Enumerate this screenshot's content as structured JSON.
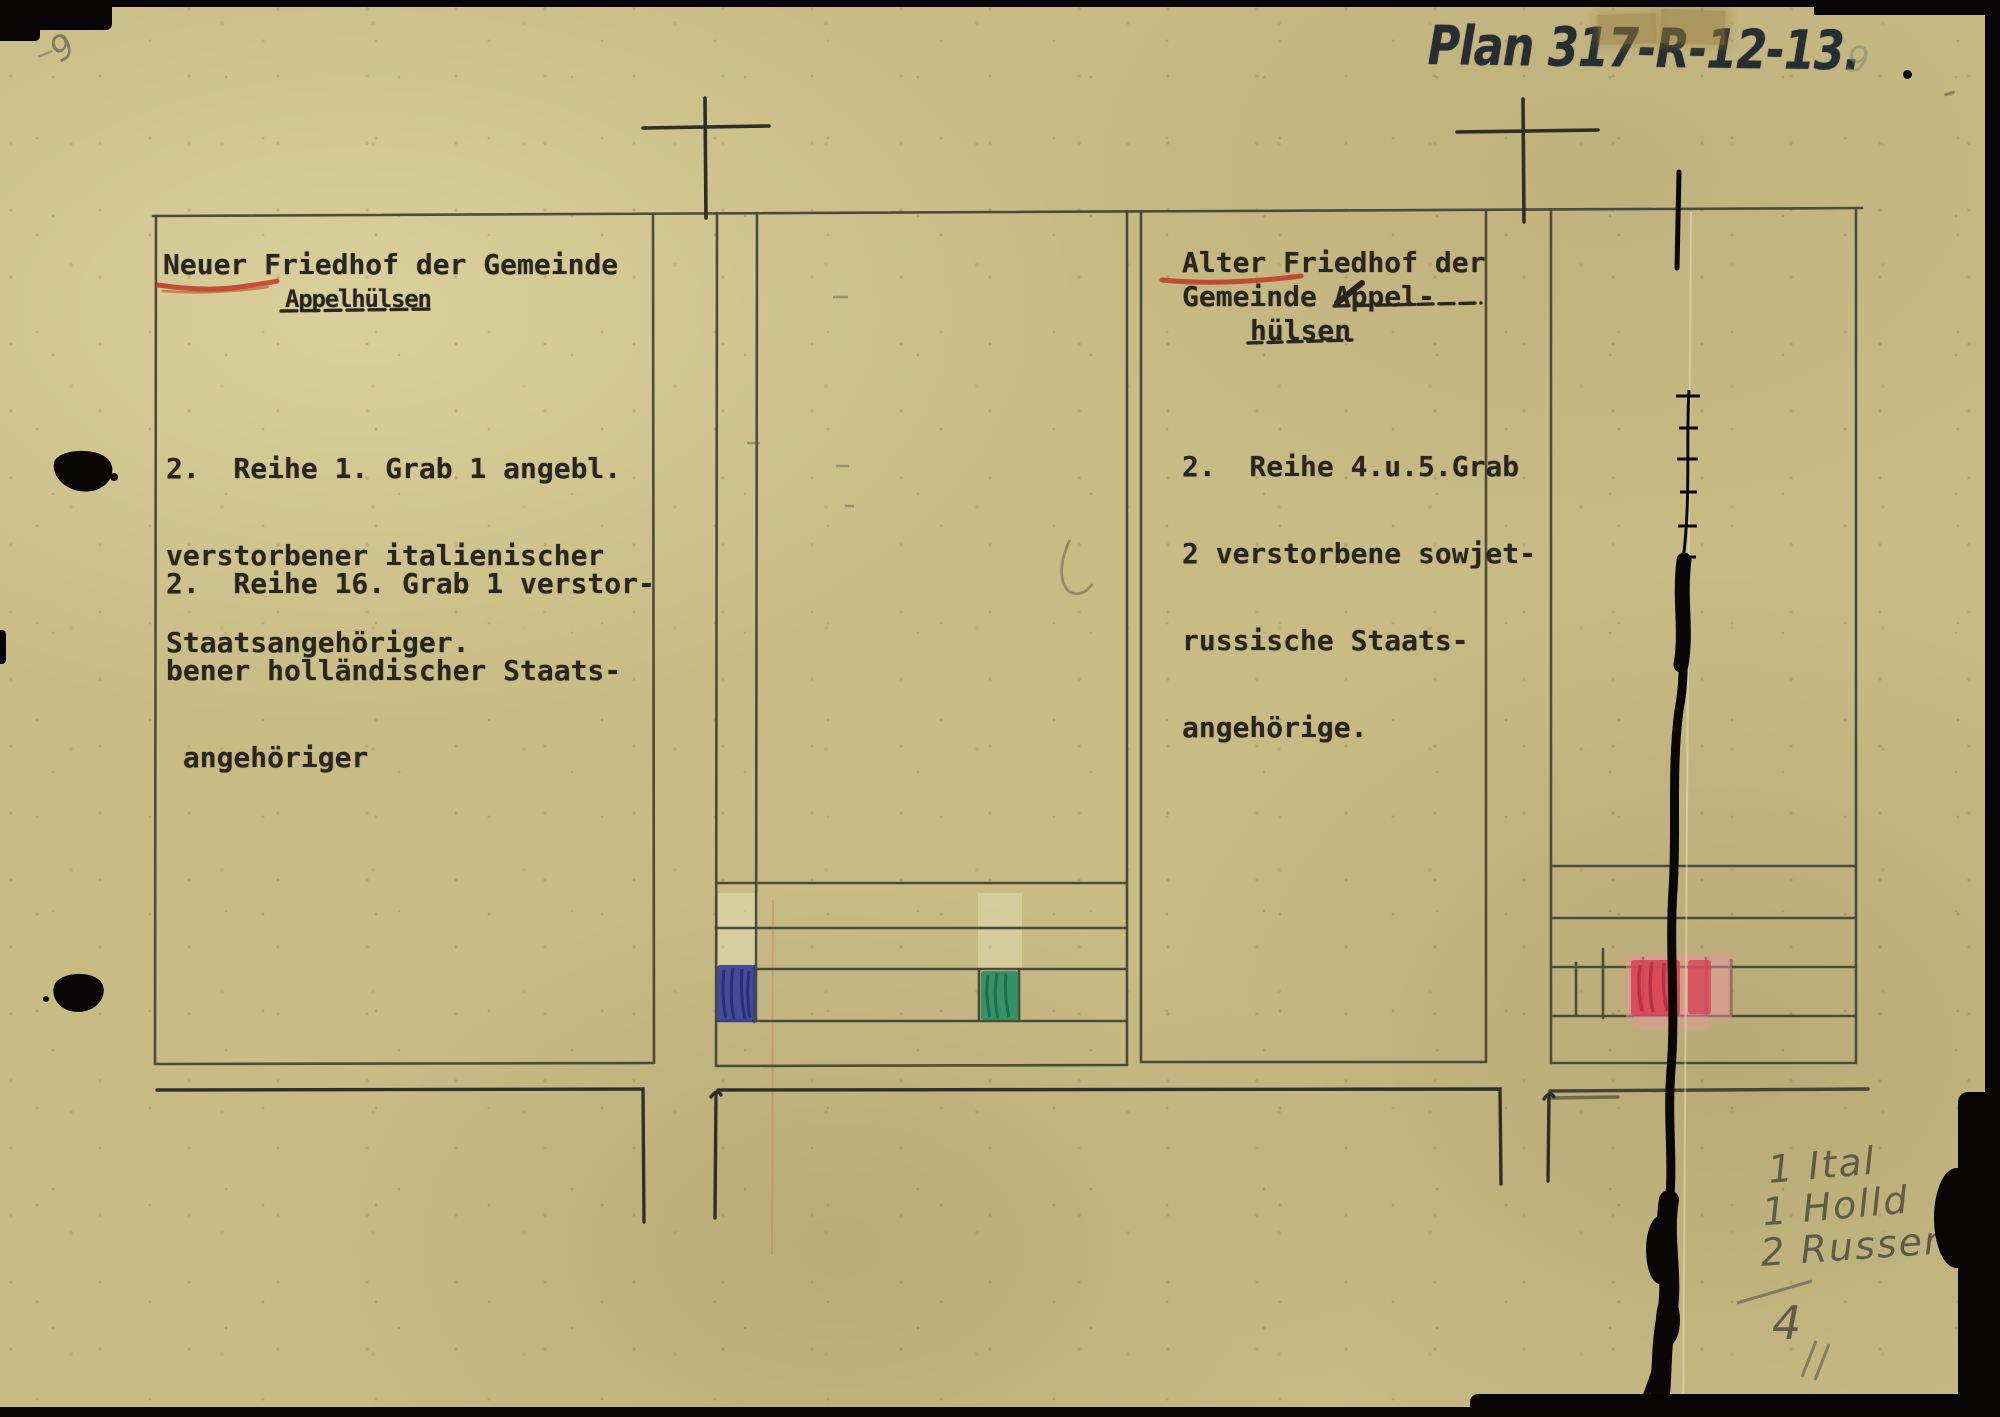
{
  "page": {
    "plan_label": "Plan 317-R-12-13.",
    "pencil_mark_top_left": "9",
    "pencil_mark_top_right": "9"
  },
  "new_cemetery": {
    "title_word_underlined": "Neuer",
    "title_rest": " Friedhof der Gemeinde",
    "title_line2": "Appelhülsen",
    "para1": [
      "2.  Reihe 1. Grab 1 angebl.",
      "verstorbener italienischer",
      "Staatsangehöriger."
    ],
    "para2": [
      "2.  Reihe 16. Grab 1 verstor-",
      "bener holländischer Staats-",
      " angehöriger"
    ]
  },
  "old_cemetery": {
    "title_word_underlined": "Alter",
    "title_rest": " Friedhof der",
    "title_line2_prefix": "Gemeinde ",
    "title_line2_underlined": "Appel-",
    "title_line3": "hülsen",
    "para": [
      "2.  Reihe 4.u.5.Grab",
      "2 verstorbene sowjet-",
      "russische Staats-",
      "angehörige."
    ]
  },
  "tally": {
    "lines": [
      "1 Ital",
      "1 Holld",
      "2 Russen"
    ],
    "total": "4"
  },
  "marker_colors": {
    "italian_grave_blue": "#333c9a",
    "dutch_grave_green": "#1e8a62",
    "russian_graves_red": "#d84355",
    "underline_red": "#bd3a26"
  }
}
